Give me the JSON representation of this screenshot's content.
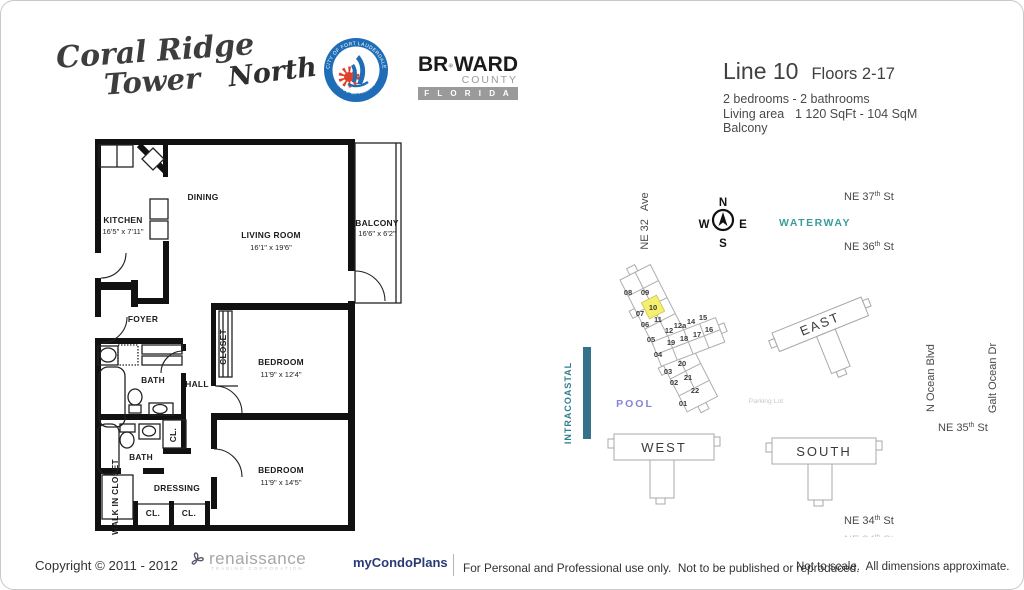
{
  "header": {
    "brand_line1": "Coral Ridge",
    "brand_line2": "Tower",
    "brand_wing": "North",
    "seal_top": "CITY OF FORT LAUDERDALE",
    "seal_bottom": "VENICE OF AMERICA",
    "broward_pre": "BR",
    "broward_post": "WARD",
    "broward_county": "COUNTY",
    "broward_state": "F L O R I D A",
    "colors": {
      "seal_blue": "#1e6db6",
      "seal_red": "#e04028",
      "broward_gray": "#9a9a9a"
    }
  },
  "unit_info": {
    "line": "Line 10",
    "floors": "Floors 2-17",
    "beds": "2 bedrooms - 2 bathrooms",
    "area_label": "Living area",
    "area_value": "1 120 SqFt - 104 SqM",
    "balcony": "Balcony"
  },
  "plan": {
    "kitchen": "KITCHEN",
    "kitchen_dims": "16'5\" x 7'11\"",
    "dining": "DINING",
    "living": "LIVING ROOM",
    "living_dims": "16'1\" x 19'6\"",
    "balcony": "BALCONY",
    "balcony_dims": "16'6\" x 6'2\"",
    "foyer": "FOYER",
    "bath1": "BATH",
    "hall": "HALL",
    "closet": "CLOSET",
    "bedroom1": "BEDROOM",
    "bedroom1_dims": "11'9\" x 12'4\"",
    "cl_upper": "CL.",
    "bath2": "BATH",
    "walkin": "WALK IN CLOSET",
    "dressing": "DRESSING",
    "cl_a": "CL.",
    "cl_b": "CL.",
    "bedroom2": "BEDROOM",
    "bedroom2_dims": "11'9\" x 14'5\""
  },
  "map": {
    "ne32_a": "NE 32",
    "ne32_b": "Ave",
    "compass": {
      "n": "N",
      "w": "W",
      "e": "E",
      "s": "S"
    },
    "waterway": "WATERWAY",
    "ne37_a": "NE 37",
    "ne37_sup": "th",
    "ne37_st": "St",
    "ne36_a": "NE 36",
    "ne36_sup": "th",
    "ne36_st": "St",
    "ne35_a": "NE 35",
    "ne35_sup": "th",
    "ne35_st": "St",
    "ne34_a": "NE 34",
    "ne34_sup": "th",
    "ne34_st": "St",
    "intracoastal": "INTRACOASTAL",
    "pool": "POOL",
    "parking": "Parking Lot",
    "east": "EAST",
    "west": "WEST",
    "south": "SOUTH",
    "units": {
      "u01": "01",
      "u02": "02",
      "u03": "03",
      "u04": "04",
      "u05": "05",
      "u06": "06",
      "u07": "07",
      "u08": "08",
      "u09": "09",
      "u10": "10",
      "u11": "11",
      "u12": "12",
      "u12a": "12a",
      "u14": "14",
      "u15": "15",
      "u16": "16",
      "u17": "17",
      "u18": "18",
      "u19": "19",
      "u20": "20",
      "u21": "21",
      "u22": "22"
    },
    "highlighted_unit": "10",
    "colors": {
      "highlight": "#f4ef6d",
      "waterway": "#3a9c9c",
      "intracoastal_text": "#2f7d8e",
      "intracoastal_bar": "#35718a",
      "pool": "#8585d6",
      "parking": "#c8c8c8",
      "building_outline": "#a8a8a8"
    }
  },
  "footer": {
    "copyright": "Copyright © 2011 - 2012",
    "vendor": "renaissance",
    "vendor_sub": "TRADING CORPORATION",
    "brand": "myCondoPlans",
    "legal": "For Personal and Professional use only.  Not to be published or reproduced.",
    "scale_note": "Not to scale.  All dimensions approximate."
  }
}
